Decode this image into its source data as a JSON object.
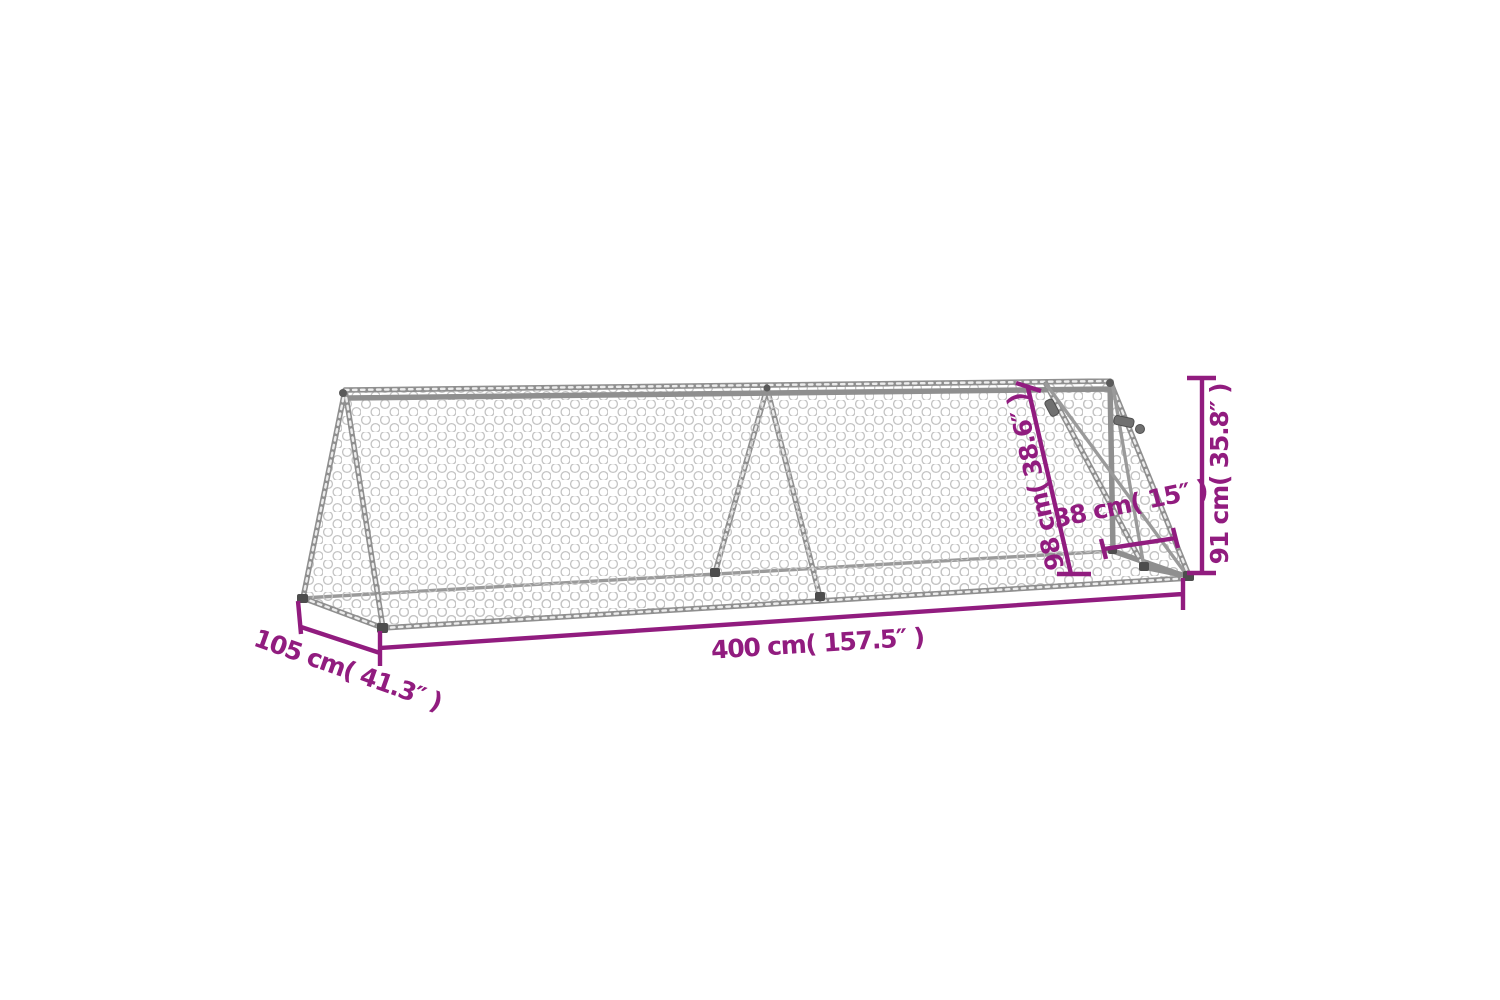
{
  "page": {
    "title": "A-frame chicken run dimension diagram",
    "background_color": "#ffffff"
  },
  "diagram": {
    "subject": "Triangular A-frame wire mesh chicken run with end door",
    "style": {
      "dimension_color": "#911c7f",
      "frame_color": "#8f8f8f",
      "mesh_color": "#c4c4c4"
    },
    "dimensions": {
      "depth": {
        "id": "depth",
        "label": "105 cm( 41.3″ )"
      },
      "length": {
        "id": "length",
        "label": "400 cm( 157.5″ )"
      },
      "slant_height": {
        "id": "slant-height",
        "label": "98 cm( 38.6″ )"
      },
      "door_width": {
        "id": "door-width",
        "label": "38 cm( 15″ )"
      },
      "height": {
        "id": "height",
        "label": "91 cm( 35.8″ )"
      }
    }
  }
}
